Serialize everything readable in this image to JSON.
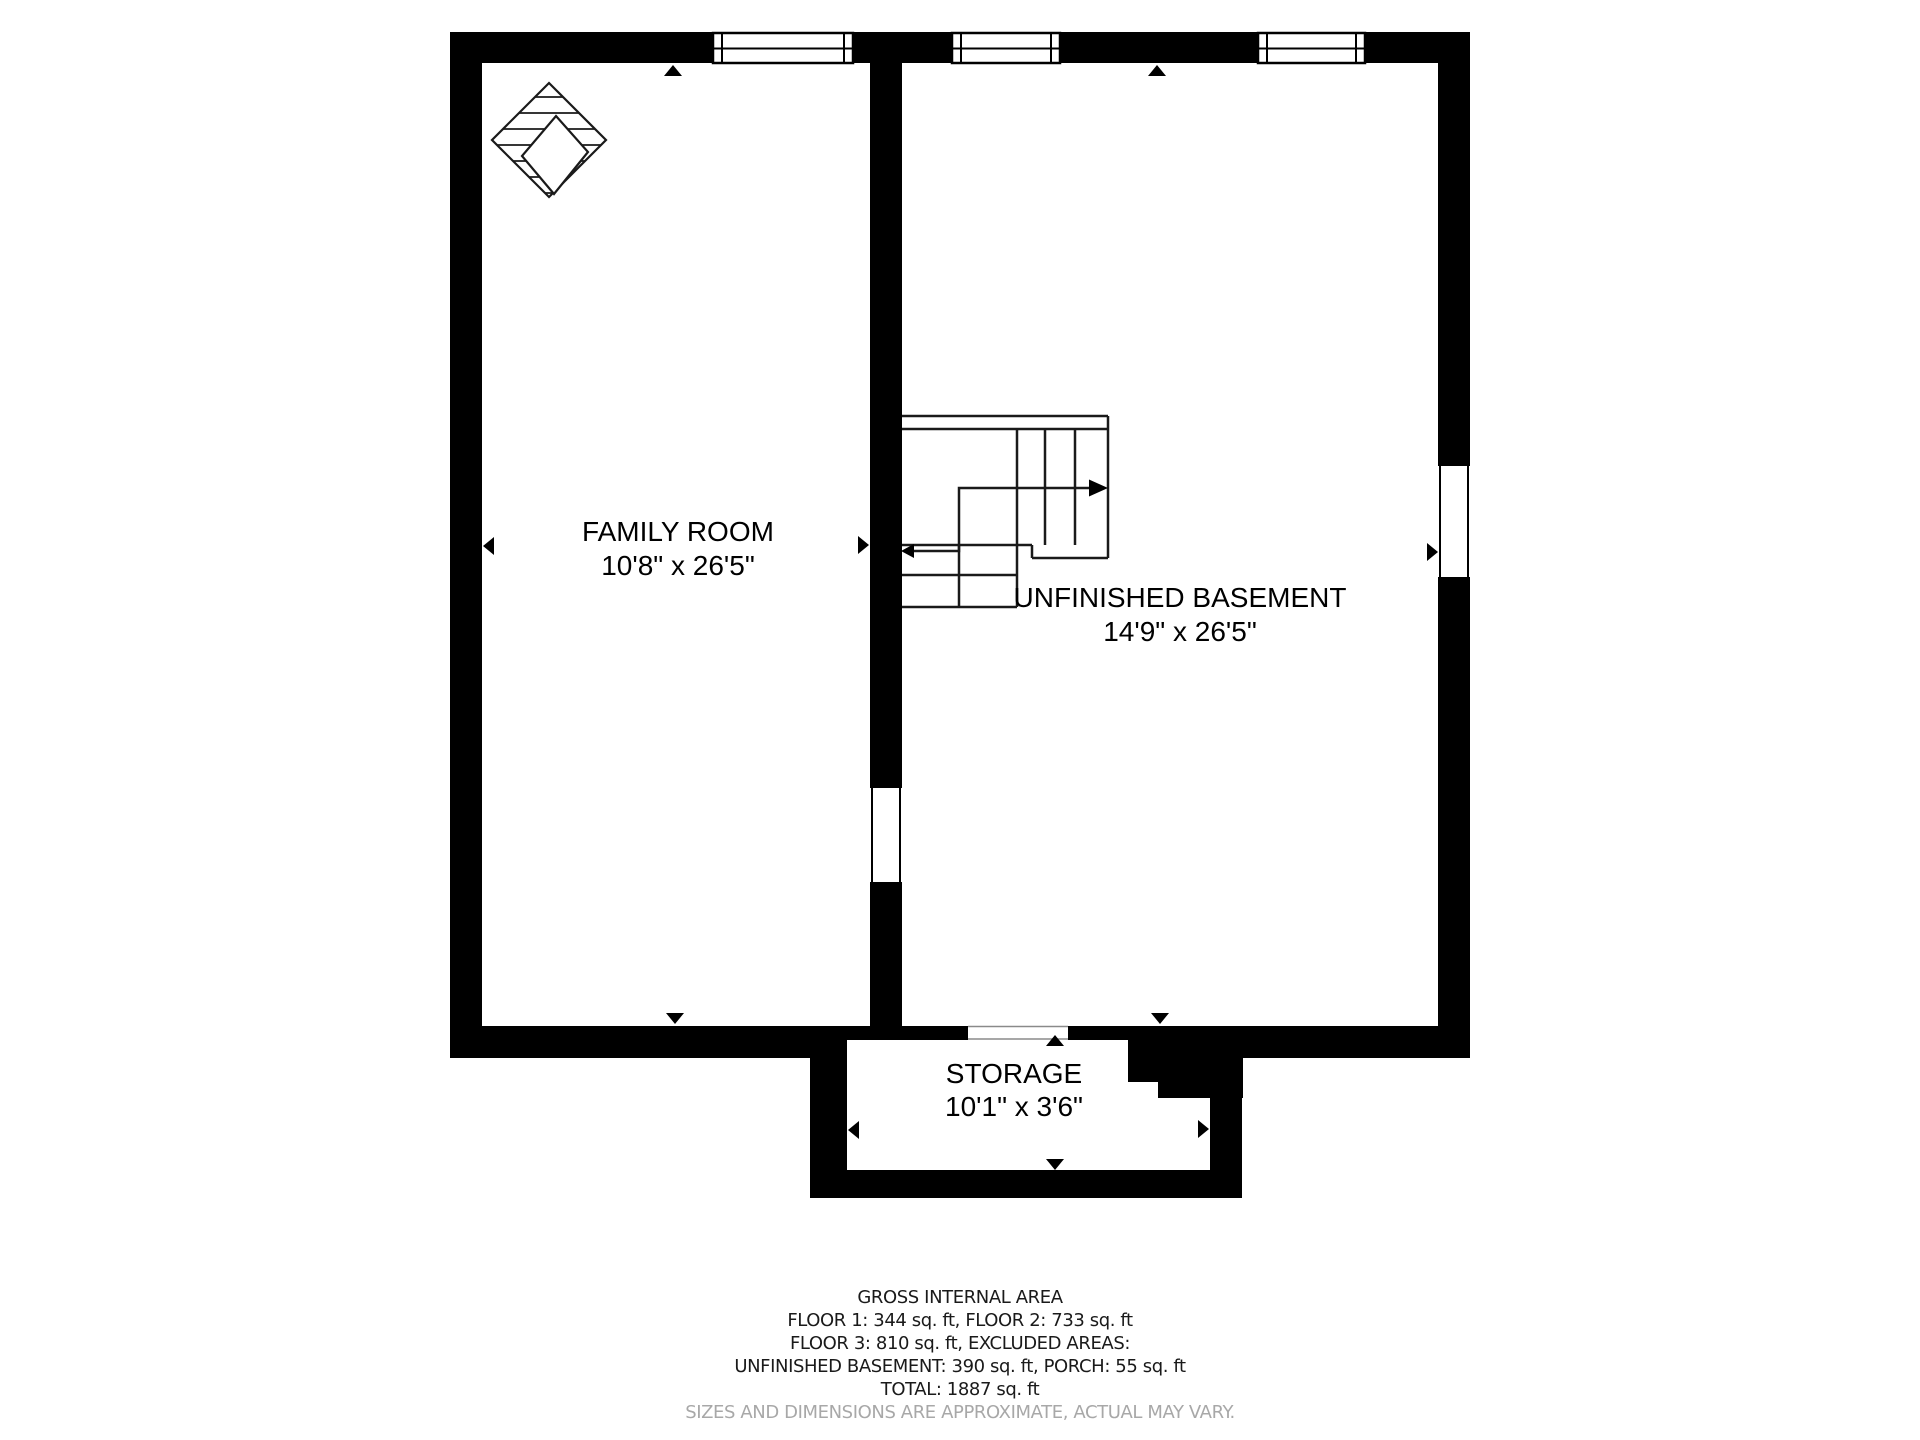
{
  "plan": {
    "rooms": {
      "family_room": {
        "name": "FAMILY ROOM",
        "dims": "10'8\" x 26'5\""
      },
      "basement": {
        "name": "UNFINISHED BASEMENT",
        "dims": "14'9\" x 26'5\""
      },
      "storage": {
        "name": "STORAGE",
        "dims": "10'1\" x 3'6\""
      }
    },
    "symbols": [
      "fireplace-icon",
      "staircase-icon",
      "window-icon",
      "direction-arrow-icon"
    ]
  },
  "caption": {
    "title": "GROSS INTERNAL AREA",
    "line1": "FLOOR 1: 344 sq. ft, FLOOR 2: 733 sq. ft",
    "line2": "FLOOR 3: 810 sq. ft, EXCLUDED AREAS:",
    "line3": "UNFINISHED BASEMENT: 390 sq. ft, PORCH: 55 sq. ft",
    "line4": "TOTAL: 1887 sq. ft",
    "disclaimer": "SIZES AND DIMENSIONS ARE APPROXIMATE, ACTUAL MAY VARY."
  },
  "colors": {
    "wall": "#000000",
    "background": "#ffffff",
    "disclaimer_text": "#a8a8a8"
  }
}
